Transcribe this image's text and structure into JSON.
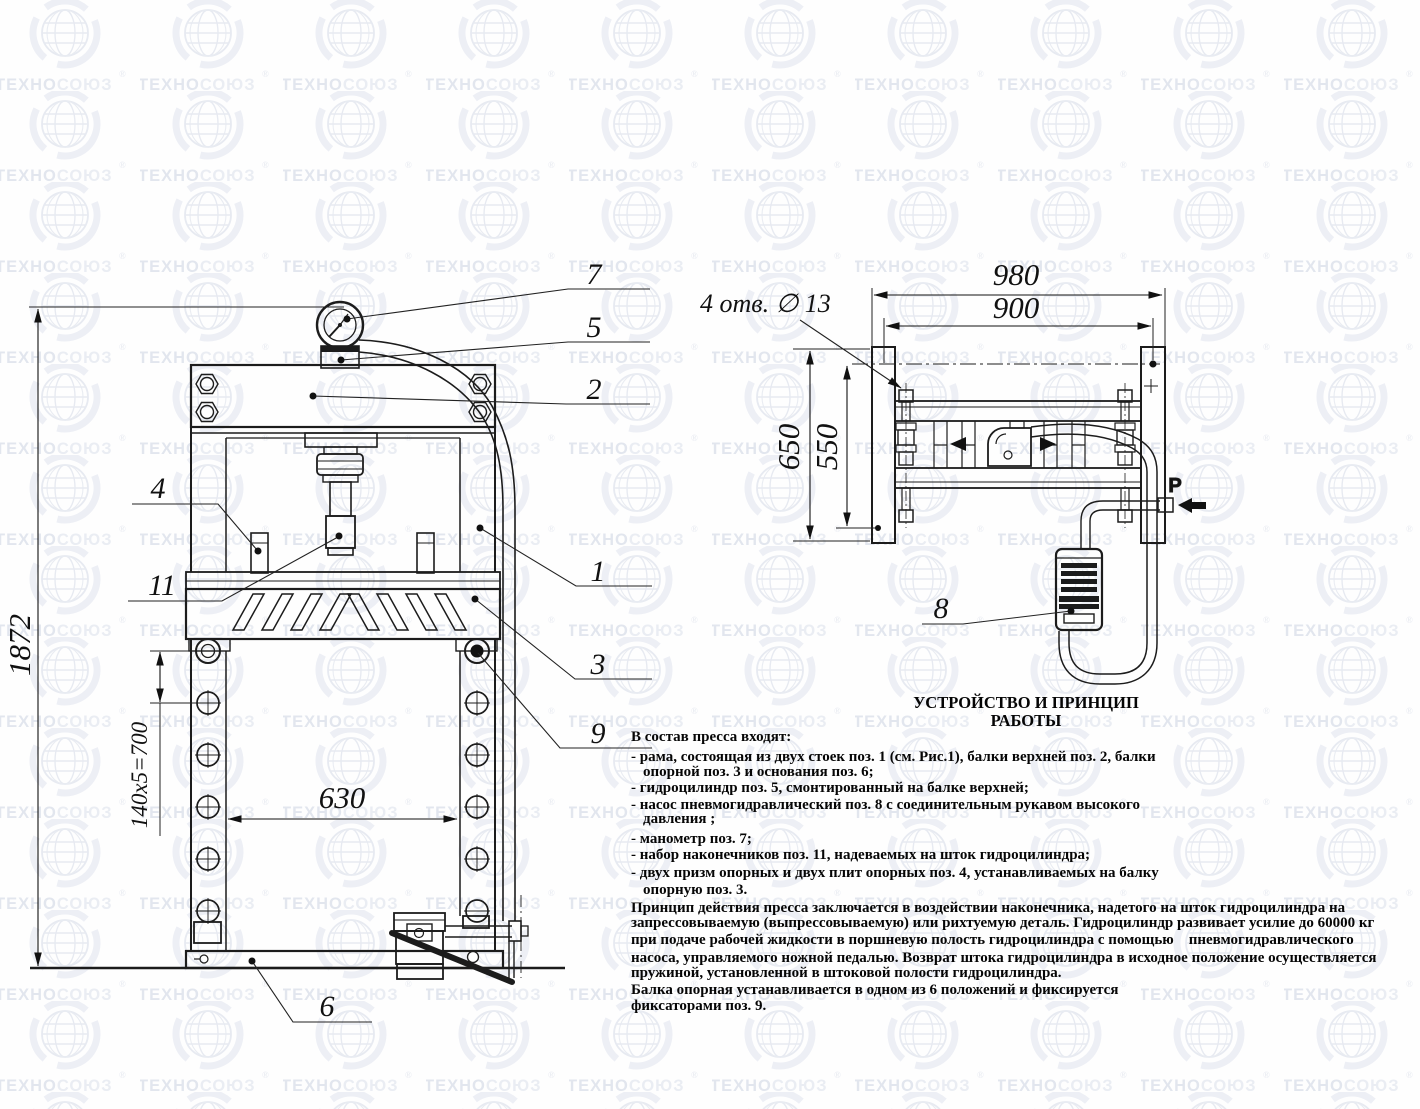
{
  "watermark": {
    "brand_part1": "ТЕХНО",
    "brand_part2": "СОЮЗ",
    "registered_mark": "®"
  },
  "front_view": {
    "dimensions": {
      "overall_height": "1872",
      "hole_pitch": "140x5=700",
      "table_width": "630"
    },
    "callouts": {
      "frame": "1",
      "upper_beam": "2",
      "support_beam": "3",
      "prism": "4",
      "cylinder": "5",
      "base": "6",
      "gauge": "7",
      "fixator": "9",
      "tip_set": "11"
    }
  },
  "top_view": {
    "dimensions": {
      "overall_width": "980",
      "mount_span": "900",
      "overall_depth": "650",
      "inner_depth": "550",
      "holes_note": "4 отв. ∅ 13"
    },
    "callouts": {
      "pump": "8"
    },
    "air_inlet_label": "P"
  },
  "description": {
    "title": "УСТРОЙСТВО И ПРИНЦИП РАБОТЫ",
    "lines": [
      "В состав пресса входят:",
      "- рама, состоящая из двух стоек поз. 1 (см. Рис.1), балки верхней поз. 2, балки",
      "опорной поз. 3 и основания поз. 6;",
      "- гидроцилиндр поз. 5, смонтированный на балке верхней;",
      "- насос пневмогидравлический поз. 8 с соединительным рукавом высокого",
      "давления ;",
      "- манометр поз. 7;",
      "- набор наконечников поз. 11, надеваемых на шток гидроцилиндра;",
      "- двух призм опорных и двух плит опорных поз. 4, устанавливаемых на балку",
      "опорную поз. 3.",
      "Принцип действия пресса заключается в воздействии наконечника, надетого на шток гидроцилиндра на",
      "запрессовываемую (выпрессовываемую) или рихтуемую деталь. Гидроцилиндр развивает усилие до 60000 кг",
      "при подаче рабочей жидкости в поршневую полость гидроцилиндра с помощью    пневмогидравлического",
      "насоса, управляемого ножной педалью. Возврат штока гидроцилиндра в исходное положение осуществляется",
      "пружиной, установленной в штоковой полости гидроцилиндра.",
      "Балка опорная устанавливается в одном из 6 положений и фиксируется",
      "фиксаторами поз. 9."
    ]
  }
}
